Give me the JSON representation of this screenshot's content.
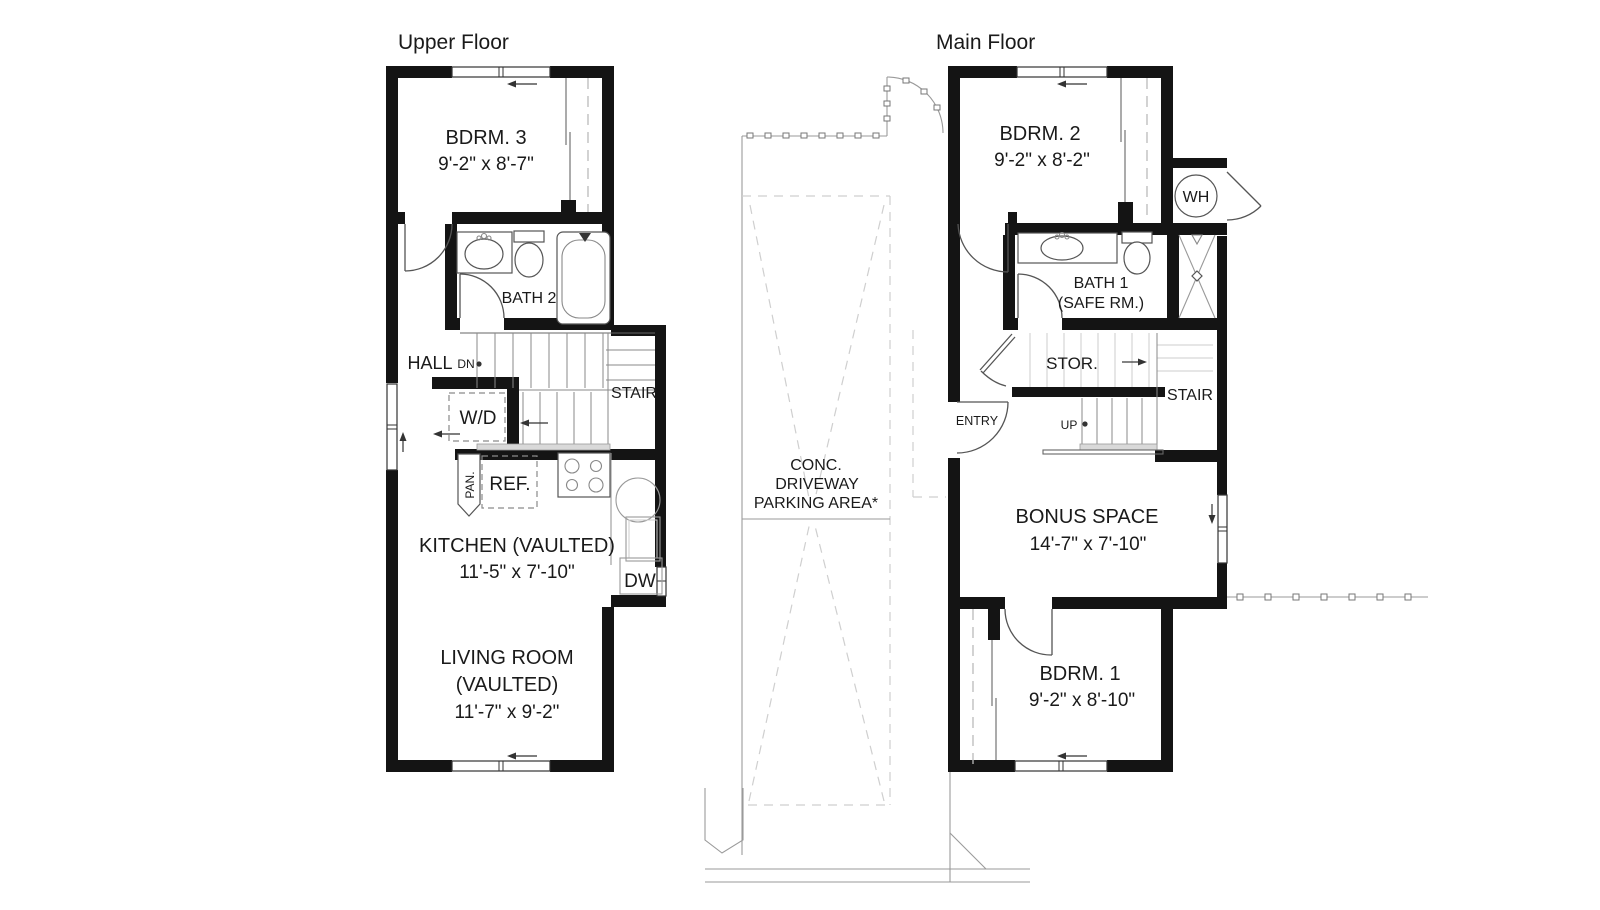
{
  "drawing": {
    "wall_color": "#141414",
    "line_color": "#666666",
    "light_line_color": "#cccccc",
    "background": "#ffffff"
  },
  "titles": {
    "upper": "Upper Floor",
    "main": "Main Floor"
  },
  "upper": {
    "bdrm3": {
      "name": "BDRM. 3",
      "dims": "9'-2\" x 8'-7\""
    },
    "bath2": "BATH 2",
    "hall": "HALL",
    "dn": "DN",
    "stair": "STAIR",
    "wd": "W/D",
    "pan": "PAN.",
    "ref": "REF.",
    "kitchen": {
      "name": "KITCHEN (VAULTED)",
      "dims": "11'-5\" x 7'-10\""
    },
    "dw": "DW",
    "living": {
      "name": "LIVING ROOM",
      "sub": "(VAULTED)",
      "dims": "11'-7\" x 9'-2\""
    }
  },
  "site": {
    "conc": "CONC.",
    "driveway": "DRIVEWAY",
    "parking": "PARKING AREA*"
  },
  "main": {
    "bdrm2": {
      "name": "BDRM. 2",
      "dims": "9'-2\" x 8'-2\""
    },
    "wh": "WH",
    "bath1": {
      "name": "BATH 1",
      "sub": "(SAFE RM.)"
    },
    "stor": "STOR.",
    "stair": "STAIR",
    "entry": "ENTRY",
    "up": "UP",
    "bonus": {
      "name": "BONUS SPACE",
      "dims": "14'-7\" x 7'-10\""
    },
    "bdrm1": {
      "name": "BDRM. 1",
      "dims": "9'-2\" x 8'-10\""
    }
  }
}
